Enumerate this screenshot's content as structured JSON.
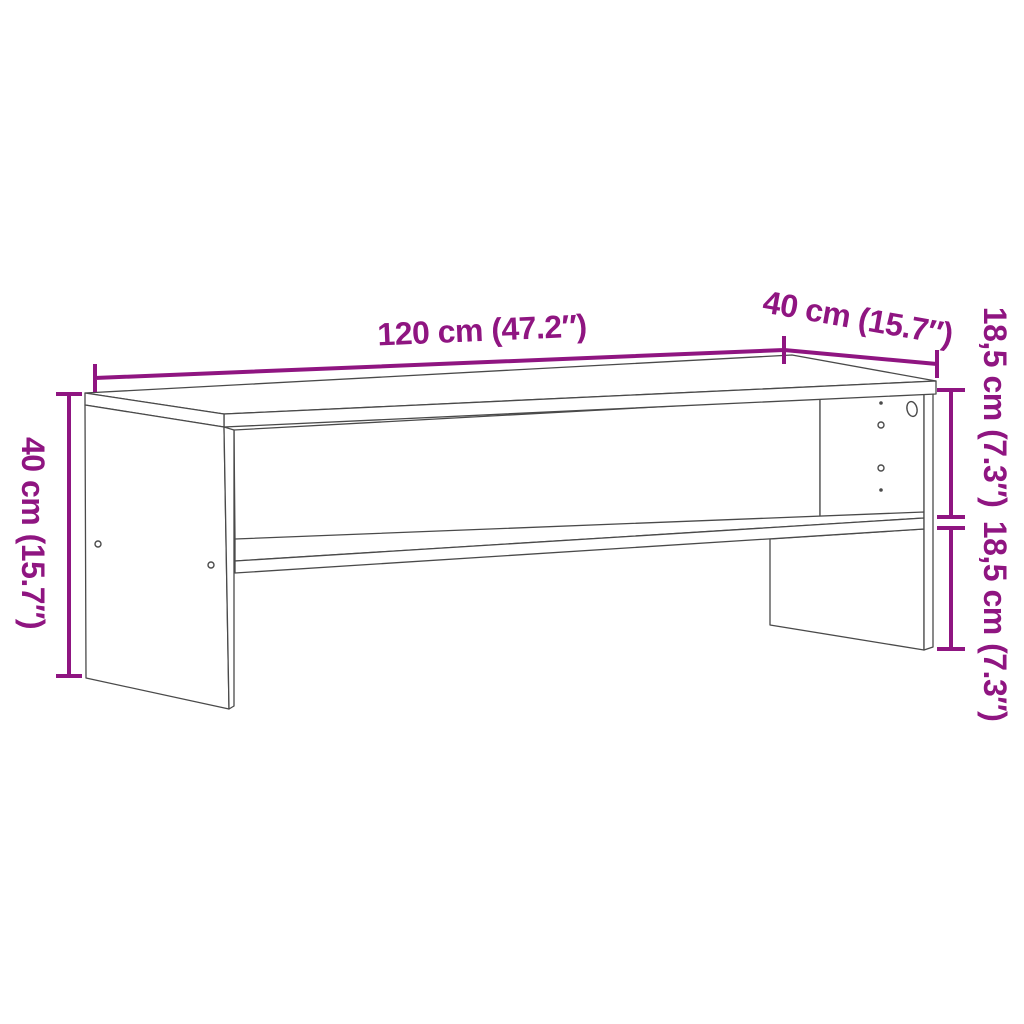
{
  "diagram": {
    "kind": "furniture dimension line drawing",
    "subject": "TV bench / media stand with open shelf compartments",
    "background_color": "#ffffff",
    "outline_color": "#4a4a4a",
    "dimension_color": "#8f1581",
    "dimensions": {
      "top_width": {
        "cm": "120",
        "inches": "47.2",
        "label": "120 cm (47.2″)"
      },
      "top_depth": {
        "cm": "40",
        "inches": "15.7",
        "label": "40 cm (15.7″)"
      },
      "side_height": {
        "cm": "40",
        "inches": "15.7",
        "label": "40 cm (15.7″)"
      },
      "upper_compartment": {
        "cm": "18,5",
        "inches": "7.3",
        "label": "18,5 cm (7.3″)"
      },
      "lower_compartment": {
        "cm": "18,5",
        "inches": "7.3",
        "label": "18,5 cm (7.3″)"
      }
    },
    "features": {
      "left_panel_screw_holes": 2,
      "right_panel_shelf_pin_holes": 4,
      "right_panel_cable_holes": 1
    }
  }
}
